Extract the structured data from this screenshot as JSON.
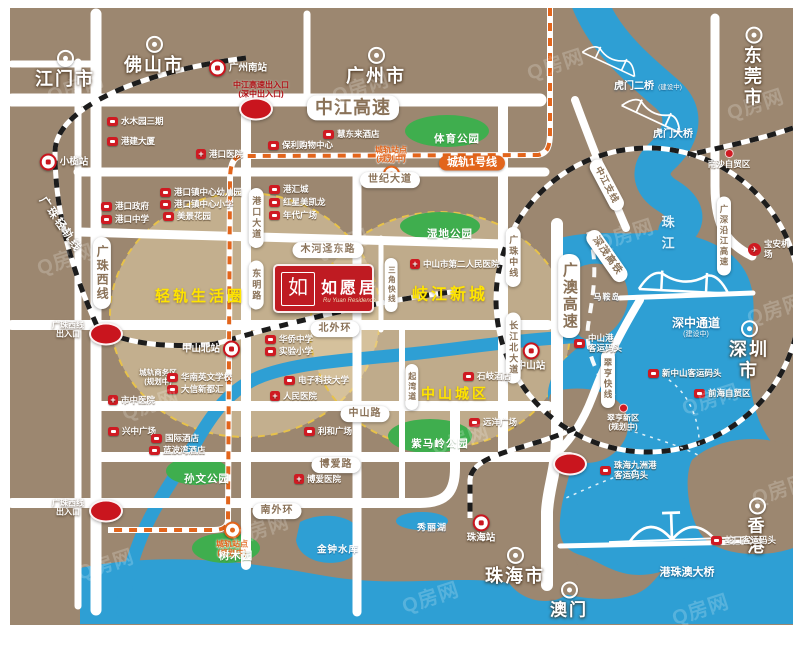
{
  "colors": {
    "land": "#9c8770",
    "water": "#2e9fd4",
    "park": "#3fae4e",
    "road": "#ffffff",
    "pill_text": "#8a7258",
    "accent_red": "#cf1a22",
    "metro_orange": "#e2651c",
    "area_yellow": "#ffe400",
    "circle_stroke": "#e7c24a",
    "logo_red": "#bf1b22"
  },
  "logo": {
    "monogram": "如",
    "title": "如愿居",
    "subtitle": "Ru Yuan Residence"
  },
  "watermark": {
    "text": "Q房网",
    "positions": [
      [
        65,
        78
      ],
      [
        350,
        78
      ],
      [
        545,
        55
      ],
      [
        745,
        95
      ],
      [
        55,
        250
      ],
      [
        330,
        235
      ],
      [
        615,
        225
      ],
      [
        765,
        300
      ],
      [
        140,
        395
      ],
      [
        450,
        430
      ],
      [
        700,
        390
      ],
      [
        95,
        555
      ],
      [
        420,
        588
      ],
      [
        690,
        600
      ],
      [
        250,
        520
      ],
      [
        770,
        480
      ]
    ]
  },
  "map": {
    "labels": [
      {
        "name": "city-jiangmen",
        "type": "city",
        "text": "江门市",
        "x": 55,
        "y": 62
      },
      {
        "name": "city-foshan",
        "type": "city",
        "text": "佛山市",
        "x": 144,
        "y": 48
      },
      {
        "name": "city-guangzhou",
        "type": "city",
        "text": "广州市",
        "x": 366,
        "y": 59
      },
      {
        "name": "city-dongguan",
        "type": "city",
        "text": "东莞市",
        "x": 744,
        "y": 60
      },
      {
        "name": "city-shenzhen",
        "type": "city",
        "text": "深圳市",
        "x": 739,
        "y": 343
      },
      {
        "name": "city-zhuhai",
        "type": "city",
        "text": "珠海市",
        "x": 505,
        "y": 559
      },
      {
        "name": "city-hongkong",
        "type": "city",
        "text": "香港",
        "x": 747,
        "y": 519,
        "fs": 17
      },
      {
        "name": "city-macau",
        "type": "city",
        "text": "澳门",
        "x": 559,
        "y": 593,
        "fs": 17
      },
      {
        "name": "station-guangzhou-south",
        "type": "station",
        "text": "广州南站",
        "x": 228,
        "y": 60,
        "side": "right"
      },
      {
        "name": "station-xiaolan",
        "type": "station",
        "text": "小榄站",
        "x": 54,
        "y": 154,
        "side": "right"
      },
      {
        "name": "station-zhongshan-north",
        "type": "station",
        "text": "中山北站",
        "x": 201,
        "y": 341,
        "side": "left"
      },
      {
        "name": "station-zhongshan",
        "type": "station",
        "text": "中山站",
        "x": 521,
        "y": 349,
        "side": "below"
      },
      {
        "name": "station-zhuhai",
        "type": "station",
        "text": "珠海站",
        "x": 471,
        "y": 521,
        "side": "below"
      },
      {
        "name": "metro-station-gangkou",
        "type": "mstation",
        "text": "城轨站点\n(规划中)",
        "x": 381,
        "y": 156,
        "side": "above"
      },
      {
        "name": "metro-station-south",
        "type": "mstation",
        "text": "城轨站点\n(规划中)",
        "x": 222,
        "y": 532,
        "side": "below"
      },
      {
        "name": "road-zhongjiang-expwy",
        "type": "pill-h",
        "text": "中江高速",
        "x": 343,
        "y": 100,
        "fs": 18
      },
      {
        "name": "road-shiji-avenue",
        "type": "pill-h",
        "text": "世纪大道",
        "x": 380,
        "y": 172
      },
      {
        "name": "road-muhejing-east",
        "type": "pill-h",
        "text": "木河迳东路",
        "x": 318,
        "y": 242
      },
      {
        "name": "road-north-ring",
        "type": "pill-h",
        "text": "北外环",
        "x": 325,
        "y": 321
      },
      {
        "name": "road-zhongshan-road",
        "type": "pill-h",
        "text": "中山路",
        "x": 355,
        "y": 406
      },
      {
        "name": "road-boai-road",
        "type": "pill-h",
        "text": "博爱路",
        "x": 326,
        "y": 457
      },
      {
        "name": "road-south-ring",
        "type": "pill-h",
        "text": "南外环",
        "x": 267,
        "y": 503
      },
      {
        "name": "metro-line1",
        "type": "metro-pill",
        "text": "城轨1号线",
        "x": 462,
        "y": 155
      },
      {
        "name": "road-guangzhu-west",
        "type": "pill-v",
        "text": "广珠西线",
        "x": 92,
        "y": 265,
        "fs": 12
      },
      {
        "name": "road-gangkou-avenue",
        "type": "pill-v",
        "text": "港口大道",
        "x": 246,
        "y": 210,
        "fs": 9
      },
      {
        "name": "road-dongming-road",
        "type": "pill-v",
        "text": "东明路",
        "x": 246,
        "y": 277,
        "fs": 9
      },
      {
        "name": "road-sanjiao-express",
        "type": "pill-v",
        "text": "三角快线",
        "x": 381,
        "y": 277,
        "fs": 7.5
      },
      {
        "name": "road-guangzhu-middle",
        "type": "pill-v",
        "text": "广珠中线",
        "x": 503,
        "y": 249,
        "fs": 9
      },
      {
        "name": "road-changjiang-north",
        "type": "pill-v",
        "text": "长江北大道",
        "x": 503,
        "y": 340,
        "fs": 9
      },
      {
        "name": "road-guangao-expwy",
        "type": "pill-v",
        "text": "广澳高速",
        "x": 559,
        "y": 288,
        "fs": 15
      },
      {
        "name": "road-qiwan-road",
        "type": "pill-v",
        "text": "起湾道",
        "x": 402,
        "y": 379,
        "fs": 8
      },
      {
        "name": "road-guangshen-riverside",
        "type": "pill-v",
        "text": "广深沿江高速",
        "x": 714,
        "y": 228,
        "fs": 8.5
      },
      {
        "name": "road-cuiheng-express",
        "type": "pill-v",
        "text": "翠亨快线",
        "x": 598,
        "y": 371,
        "fs": 8.5
      },
      {
        "name": "road-zhongjiang-branch",
        "type": "pill-rot",
        "text": "中江支线",
        "x": 597,
        "y": 177,
        "fs": 9,
        "rot": 62
      },
      {
        "name": "rail-shenmao-hsr",
        "type": "pill-rot",
        "text": "深茂高铁",
        "x": 597,
        "y": 248,
        "fs": 10,
        "rot": 55
      },
      {
        "name": "rail-guangzhu-light",
        "type": "rail-text",
        "text": "广珠轻轨线",
        "x": 50,
        "y": 217,
        "fs": 11,
        "rot": 55
      },
      {
        "name": "area-lightrail-circle",
        "type": "area",
        "text": "轻轨生活圈",
        "x": 190,
        "y": 289,
        "fs": 15
      },
      {
        "name": "area-qijiang-newtown",
        "type": "area",
        "text": "岐江新城",
        "x": 440,
        "y": 288,
        "fs": 16
      },
      {
        "name": "area-zhongshan-urban",
        "type": "area",
        "text": "中山城区",
        "x": 445,
        "y": 386,
        "fs": 14
      },
      {
        "name": "park-tiyu",
        "type": "park",
        "text": "体育公园",
        "x": 447,
        "y": 131
      },
      {
        "name": "park-shidi",
        "type": "park",
        "text": "湿地公园",
        "x": 440,
        "y": 226
      },
      {
        "name": "park-sunwen",
        "type": "park",
        "text": "孙文公园",
        "x": 197,
        "y": 471
      },
      {
        "name": "park-shumuyuan",
        "type": "park",
        "text": "树木园",
        "x": 226,
        "y": 548
      },
      {
        "name": "park-zimaling",
        "type": "park",
        "text": "紫马岭公园",
        "x": 430,
        "y": 436
      },
      {
        "name": "water-jinzhong-reservoir",
        "type": "water",
        "text": "金钟水库",
        "x": 328,
        "y": 542,
        "fs": 9.5
      },
      {
        "name": "water-xiuli-lake",
        "type": "water",
        "text": "秀丽湖",
        "x": 422,
        "y": 520,
        "fs": 9
      },
      {
        "name": "island-maan",
        "type": "water",
        "text": "马鞍岛",
        "x": 597,
        "y": 289,
        "fs": 8
      },
      {
        "name": "water-pearl-river",
        "type": "water-v",
        "text": "珠江",
        "x": 657,
        "y": 228
      },
      {
        "name": "bridge-humen2-label",
        "type": "blabel",
        "text": "虎门二桥",
        "x": 624,
        "y": 79
      },
      {
        "name": "bridge-humen2-status",
        "type": "small-note",
        "text": "(建设中)",
        "x": 660,
        "y": 80
      },
      {
        "name": "bridge-humen-label",
        "type": "blabel",
        "text": "虎门大桥",
        "x": 663,
        "y": 127
      },
      {
        "name": "bridge-shenzhong-label",
        "type": "blabel",
        "text": "深中通道",
        "x": 686,
        "y": 315,
        "fs": 12
      },
      {
        "name": "bridge-shenzhong-status",
        "type": "small-note",
        "text": "(建设中)",
        "x": 686,
        "y": 327,
        "fs": 7
      },
      {
        "name": "bridge-hzmb-label",
        "type": "blabel",
        "text": "港珠澳大桥",
        "x": 677,
        "y": 565,
        "fs": 11
      },
      {
        "name": "interchange-zhongjiang",
        "type": "interchange",
        "text": "",
        "x": 246,
        "y": 101
      },
      {
        "name": "interchange-guangzhuxi-n",
        "type": "interchange",
        "text": "",
        "x": 96,
        "y": 326
      },
      {
        "name": "interchange-guangzhuxi-s",
        "type": "interchange",
        "text": "",
        "x": 96,
        "y": 503
      },
      {
        "name": "interchange-guangao",
        "type": "interchange",
        "text": "",
        "x": 560,
        "y": 456
      },
      {
        "name": "note-zhongjiang-exit",
        "type": "red-note",
        "text": "中江高速出入口\n(深中出入口)",
        "x": 251,
        "y": 82
      },
      {
        "name": "note-guangzhuxi-exit-n",
        "type": "white-note",
        "text": "广珠西线\n出入口",
        "x": 58,
        "y": 322
      },
      {
        "name": "note-guangzhuxi-exit-s",
        "type": "white-note",
        "text": "广珠西线\n出入口",
        "x": 58,
        "y": 500
      },
      {
        "name": "note-rail-biz-area",
        "type": "white-note",
        "text": "城轨商务区\n(规划中)",
        "x": 148,
        "y": 370,
        "fs": 7.5
      },
      {
        "name": "poi-baoan-airport",
        "type": "airport",
        "text": "宝安机场",
        "x": 738,
        "y": 241
      },
      {
        "name": "note-nansha-ftz",
        "type": "dot-note",
        "text": "南沙自贸区",
        "x": 719,
        "y": 151
      },
      {
        "name": "note-cuiheng-newarea",
        "type": "dot-note",
        "text": "翠亨新区\n(规划中)",
        "x": 613,
        "y": 410,
        "fs": 8
      },
      {
        "name": "poi-shuimuyuan",
        "type": "poi",
        "text": "水木园三期",
        "x": 97,
        "y": 113
      },
      {
        "name": "poi-gangjian-tower",
        "type": "poi",
        "text": "港建大厦",
        "x": 97,
        "y": 133
      },
      {
        "name": "poi-gangkou-hospital",
        "type": "poi-hosp",
        "text": "港口医院",
        "x": 186,
        "y": 146
      },
      {
        "name": "poi-baoli-mall",
        "type": "poi",
        "text": "保利购物中心",
        "x": 258,
        "y": 137
      },
      {
        "name": "poi-huidonglai-hotel",
        "type": "poi",
        "text": "慧东来酒店",
        "x": 313,
        "y": 126
      },
      {
        "name": "poi-gangkou-kindergarten",
        "type": "poi",
        "text": "港口镇中心幼儿园",
        "x": 150,
        "y": 184
      },
      {
        "name": "poi-gangkou-primary",
        "type": "poi",
        "text": "港口镇中心小学",
        "x": 150,
        "y": 196
      },
      {
        "name": "poi-meijing-garden",
        "type": "poi",
        "text": "美景花园",
        "x": 153,
        "y": 208
      },
      {
        "name": "poi-gangkou-gov",
        "type": "poi",
        "text": "港口政府",
        "x": 91,
        "y": 198
      },
      {
        "name": "poi-gangkou-middle",
        "type": "poi",
        "text": "港口中学",
        "x": 91,
        "y": 211
      },
      {
        "name": "poi-ganghui-city",
        "type": "poi",
        "text": "港汇城",
        "x": 259,
        "y": 181
      },
      {
        "name": "poi-hongxing-meikailong",
        "type": "poi",
        "text": "红星美凯龙",
        "x": 259,
        "y": 194
      },
      {
        "name": "poi-niandai-plaza",
        "type": "poi",
        "text": "年代广场",
        "x": 259,
        "y": 207
      },
      {
        "name": "poi-huaqiao-middle",
        "type": "poi",
        "text": "华侨中学",
        "x": 255,
        "y": 331
      },
      {
        "name": "poi-shiyan-primary",
        "type": "poi",
        "text": "实验小学",
        "x": 255,
        "y": 343
      },
      {
        "name": "poi-english-school",
        "type": "poi",
        "text": "华南英文学校",
        "x": 157,
        "y": 369
      },
      {
        "name": "poi-daxin-mall",
        "type": "poi",
        "text": "大信新都汇",
        "x": 157,
        "y": 381
      },
      {
        "name": "poi-uestc",
        "type": "poi",
        "text": "电子科技大学",
        "x": 274,
        "y": 372
      },
      {
        "name": "poi-renmin-hospital",
        "type": "poi-hosp",
        "text": "人民医院",
        "x": 260,
        "y": 388
      },
      {
        "name": "poi-tcm-hospital",
        "type": "poi-hosp",
        "text": "市中医院",
        "x": 98,
        "y": 392
      },
      {
        "name": "poi-xingzhong-plaza",
        "type": "poi",
        "text": "兴中广场",
        "x": 98,
        "y": 423
      },
      {
        "name": "poi-intl-hotel",
        "type": "poi",
        "text": "国际酒店",
        "x": 141,
        "y": 430
      },
      {
        "name": "poi-lanbowan-hotel",
        "type": "poi",
        "text": "蓝波湾酒店",
        "x": 139,
        "y": 442
      },
      {
        "name": "poi-lihe-plaza",
        "type": "poi",
        "text": "利和广场",
        "x": 294,
        "y": 423
      },
      {
        "name": "poi-yuanyang-plaza",
        "type": "poi",
        "text": "远洋广场",
        "x": 459,
        "y": 414
      },
      {
        "name": "poi-second-hospital",
        "type": "poi-hosp",
        "text": "中山市第二人民医院",
        "x": 400,
        "y": 256
      },
      {
        "name": "poi-boai-hospital",
        "type": "poi-hosp",
        "text": "博爱医院",
        "x": 284,
        "y": 471
      },
      {
        "name": "poi-shiqi-hotel",
        "type": "poi",
        "text": "石岐酒店",
        "x": 453,
        "y": 368
      },
      {
        "name": "poi-zhongshan-port",
        "type": "poi2",
        "text": "中山港\n客运码头",
        "x": 564,
        "y": 335
      },
      {
        "name": "poi-new-zhongshan-ferry",
        "type": "poi",
        "text": "新中山客运码头",
        "x": 638,
        "y": 365
      },
      {
        "name": "poi-shekou-ferry",
        "type": "poi",
        "text": "蛇口客运码头",
        "x": 701,
        "y": 532
      },
      {
        "name": "poi-jiuzhou-ferry",
        "type": "poi2",
        "text": "珠海九洲港\n客运码头",
        "x": 590,
        "y": 462
      },
      {
        "name": "poi-qianhai-ftz",
        "type": "poi",
        "text": "前海自贸区",
        "x": 684,
        "y": 385
      }
    ]
  }
}
